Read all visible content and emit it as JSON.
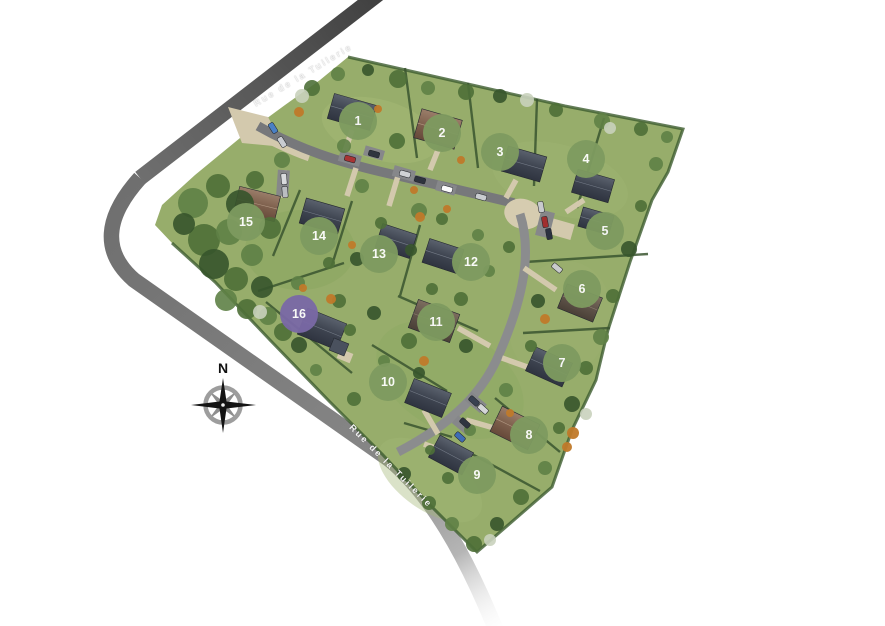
{
  "site": {
    "road_labels": {
      "top": "Rue de la Tuilerie",
      "bottom": "Rue de la Tuilerie"
    },
    "compass": {
      "north": "N"
    }
  },
  "markers": {
    "size_px": 38,
    "colors": {
      "available": "#7E9B60",
      "highlight": "#7A69A6"
    },
    "lots": [
      {
        "number": "1",
        "x": 358,
        "y": 121,
        "state": "available"
      },
      {
        "number": "2",
        "x": 442,
        "y": 133,
        "state": "available"
      },
      {
        "number": "3",
        "x": 500,
        "y": 152,
        "state": "available"
      },
      {
        "number": "4",
        "x": 586,
        "y": 159,
        "state": "available"
      },
      {
        "number": "5",
        "x": 605,
        "y": 231,
        "state": "available"
      },
      {
        "number": "6",
        "x": 582,
        "y": 289,
        "state": "available"
      },
      {
        "number": "7",
        "x": 562,
        "y": 363,
        "state": "available"
      },
      {
        "number": "8",
        "x": 529,
        "y": 435,
        "state": "available"
      },
      {
        "number": "9",
        "x": 477,
        "y": 475,
        "state": "available"
      },
      {
        "number": "10",
        "x": 388,
        "y": 382,
        "state": "available"
      },
      {
        "number": "11",
        "x": 436,
        "y": 322,
        "state": "available"
      },
      {
        "number": "12",
        "x": 471,
        "y": 262,
        "state": "available"
      },
      {
        "number": "13",
        "x": 379,
        "y": 254,
        "state": "available"
      },
      {
        "number": "14",
        "x": 319,
        "y": 236,
        "state": "available"
      },
      {
        "number": "15",
        "x": 246,
        "y": 222,
        "state": "available"
      },
      {
        "number": "16",
        "x": 299,
        "y": 314,
        "state": "highlight"
      }
    ]
  }
}
